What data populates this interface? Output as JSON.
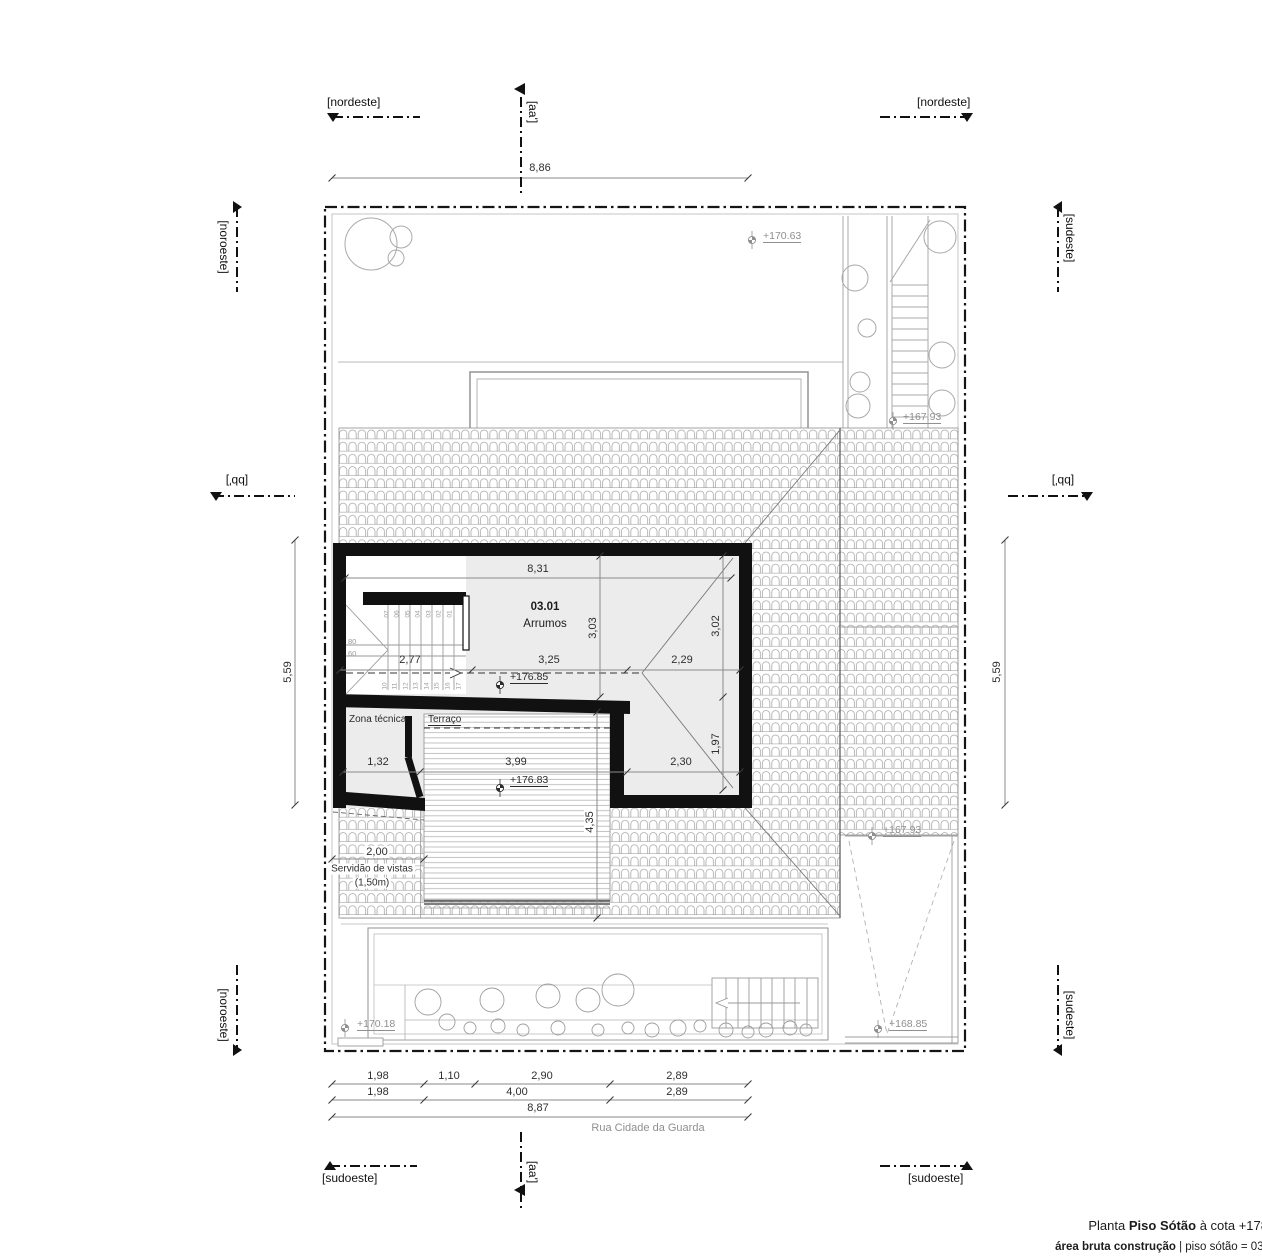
{
  "drawing": {
    "title": {
      "prefix": "Planta",
      "name": "Piso Sótão",
      "cota": "à cota +178",
      "area_label": "área bruta construção",
      "area_value": "| piso sótão = 031"
    },
    "street": "Rua Cidade da Guarda"
  },
  "markers": {
    "nordeste": "[nordeste]",
    "sudoeste": "[sudoeste]",
    "noroeste": "[noroeste]",
    "sudeste": "[sudeste]",
    "aa": "[aa']",
    "bb": "[bb']"
  },
  "rooms": {
    "main_number": "03.01",
    "main_name": "Arrumos",
    "zona_tecnica": "Zona técnica",
    "terraco": "Terraço"
  },
  "levels": {
    "top_garden": "+170.63",
    "upper_stair": "+167.93",
    "attic_floor": "+176.85",
    "terrace_floor": "+176.83",
    "mid_right": "+167.93",
    "bottom_left": "+170.18",
    "ramp": "+168.85"
  },
  "easement": {
    "line1": "Servidão de vistas",
    "line2": "(1,50m)"
  },
  "dims": {
    "site_top": "8,86",
    "site_left": "5,59",
    "site_right": "5,59",
    "room_top": "8,31",
    "room_left_h": "3,03",
    "room_right_h": "3,02",
    "stair_w": "2,77",
    "room_mid": "3,25",
    "roof_right": "2,29",
    "zt_w": "1,32",
    "terrace_w": "3,99",
    "lower_right_w": "2,30",
    "right_lower_h": "1,97",
    "terrace_h": "4,35",
    "easement_w": "2,00",
    "bottom_row1": [
      "1,98",
      "1,10",
      "2,90",
      "2,89"
    ],
    "bottom_row2": [
      "1,98",
      "4,00",
      "2,89"
    ],
    "bottom_total": "8,87"
  },
  "stair": {
    "upper_treads": [
      "07",
      "06",
      "05",
      "04",
      "03",
      "02",
      "01"
    ],
    "lower_treads": [
      "10",
      "11",
      "12",
      "13",
      "14",
      "15",
      "16",
      "17"
    ],
    "landing_labels": [
      "80",
      "60"
    ]
  }
}
